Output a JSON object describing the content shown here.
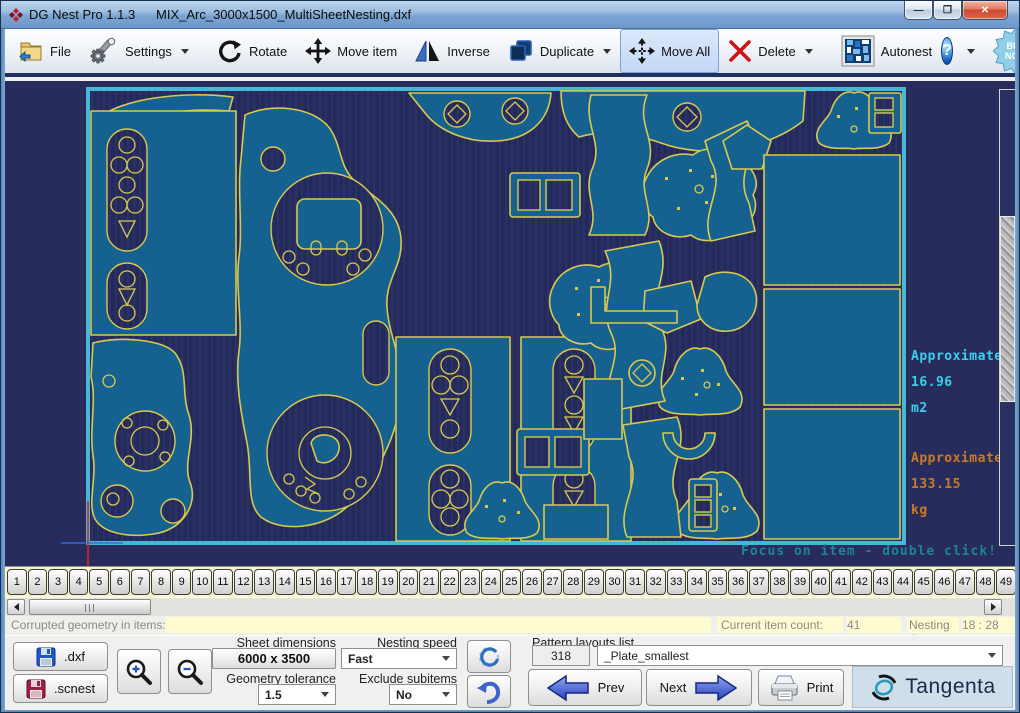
{
  "window": {
    "app_title": "DG Nest Pro 1.1.3",
    "document_title": "MIX_Arc_3000x1500_MultiSheetNesting.dxf",
    "minimize": "—",
    "maximize": "❐",
    "close": "✕"
  },
  "toolbar": {
    "file": "File",
    "settings": "Settings",
    "rotate": "Rotate",
    "move_item": "Move item",
    "inverse": "Inverse",
    "duplicate": "Duplicate",
    "move_all": "Move All",
    "delete": "Delete",
    "autonest": "Autonest",
    "help": "?",
    "buy_now_line1": "BUY",
    "buy_now_line2": "NOW"
  },
  "canvas": {
    "area_label": "Approximate",
    "area_value": "16.96",
    "area_unit": "m2",
    "weight_label": "Approximate",
    "weight_value": "133.15",
    "weight_unit": "kg",
    "focus_hint": "Focus on item - double click!",
    "colors": {
      "canvas_bg": "#272c5c",
      "part_fill": "#15618f",
      "part_outline": "#d9c94f",
      "sheet_border": "#46b8d4",
      "area_text": "#38d2ea",
      "weight_text": "#cc7a22",
      "focus_text": "#1c8496",
      "origin_x_axis": "#dd2222",
      "origin_y_axis": "#3a6ad0",
      "selected_tool_bg": "#c3d7f5"
    }
  },
  "pager": {
    "numbers": [
      1,
      2,
      3,
      4,
      5,
      6,
      7,
      8,
      9,
      10,
      11,
      12,
      13,
      14,
      15,
      16,
      17,
      18,
      19,
      20,
      21,
      22,
      23,
      24,
      25,
      26,
      27,
      28,
      29,
      30,
      31,
      32,
      33,
      34,
      35,
      36,
      37,
      38,
      39,
      40,
      41,
      42,
      43,
      44,
      45,
      46,
      47,
      48,
      49
    ]
  },
  "status": {
    "corrupted_label": "Corrupted geometry in items:",
    "corrupted_value": "",
    "item_count_label": "Current item count:",
    "item_count_value": "41",
    "nesting_time_label": "Nesting time:",
    "nesting_time_value": "18 : 28"
  },
  "controls": {
    "save_dxf": ".dxf",
    "save_scnest": ".scnest",
    "sheet_dimensions_label": "Sheet dimensions",
    "sheet_dimensions_value": "6000 x 3500",
    "geometry_tolerance_label": "Geometry tolerance (mm)",
    "geometry_tolerance_value": "1.5",
    "nesting_speed_label": "Nesting speed",
    "nesting_speed_value": "Fast",
    "exclude_subitems_label": "Exclude subitems",
    "exclude_subitems_value": "No",
    "pattern_layouts_label": "Pattern layouts list",
    "pattern_count": "318",
    "pattern_selected": "_Plate_smallest",
    "prev": "Prev",
    "next": "Next",
    "print": "Print",
    "brand": "Tangenta"
  }
}
